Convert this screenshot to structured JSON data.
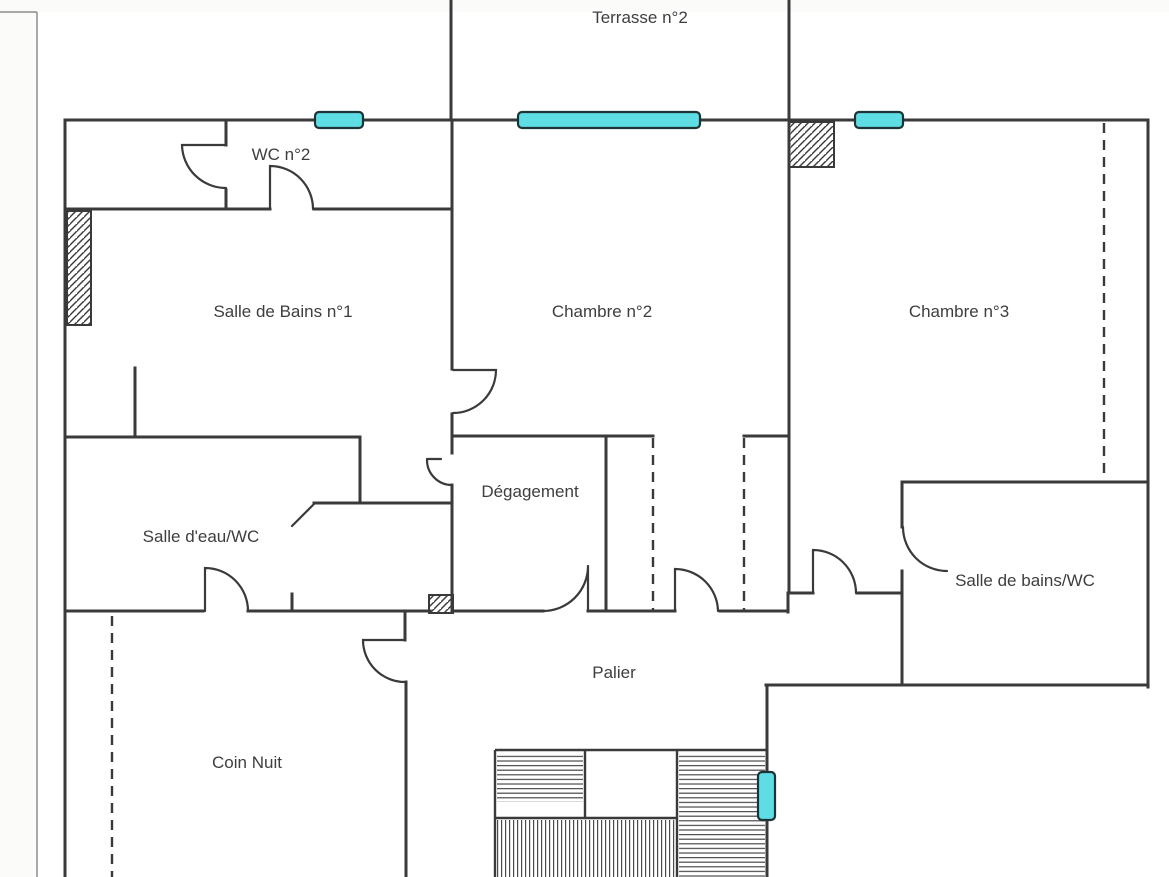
{
  "plan": {
    "rooms": {
      "terrasse": "Terrasse n°2",
      "wc2": "WC n°2",
      "salle_de_bains_1": "Salle de Bains n°1",
      "chambre_2": "Chambre n°2",
      "chambre_3": "Chambre n°3",
      "degagement": "Dégagement",
      "salle_deau_wc": "Salle d'eau/WC",
      "salle_de_bains_wc": "Salle de bains/WC",
      "palier": "Palier",
      "coin_nuit": "Coin Nuit"
    },
    "colors": {
      "wall": "#3a3a3a",
      "window_glass": "#5edde4",
      "window_border": "#1d3335",
      "label_text": "#3e3e3e",
      "page_edge": "#8d8d8d",
      "stair_stripe": "#4a4a4a",
      "background": "#fbfbfa",
      "page_background": "#ffffff"
    }
  }
}
